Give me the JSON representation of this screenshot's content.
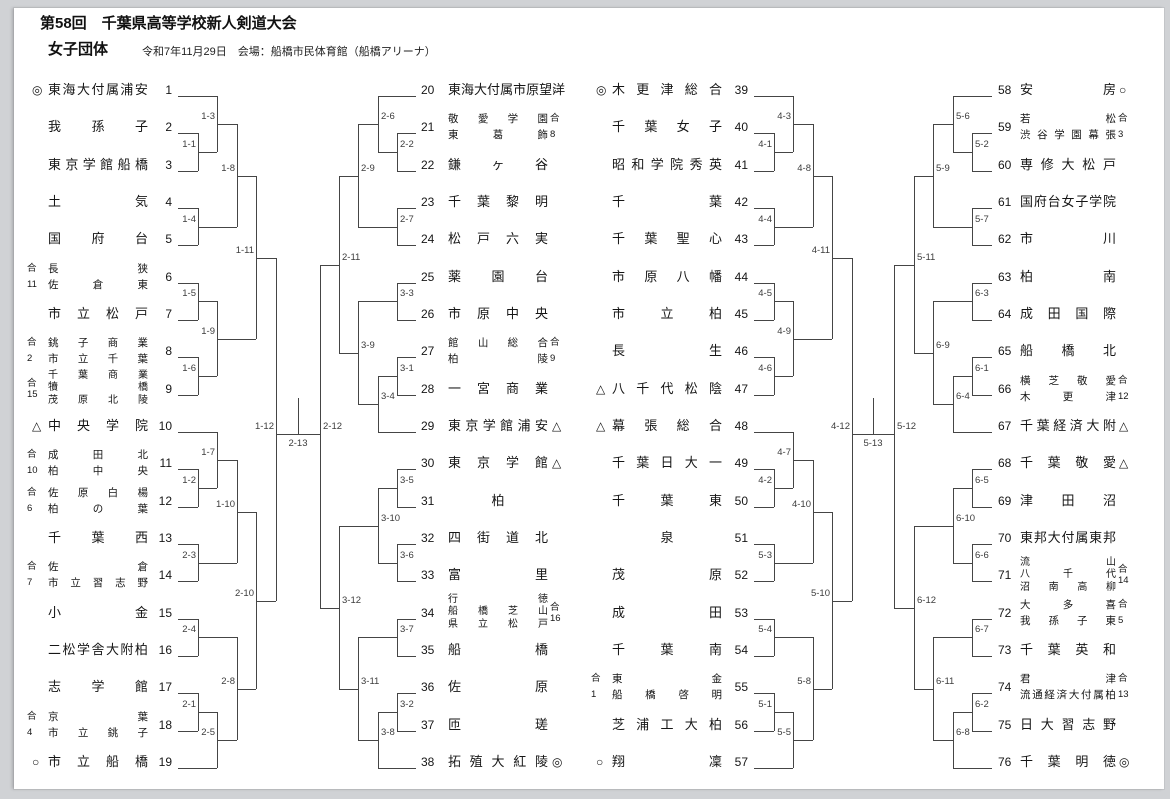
{
  "page": {
    "title": "第58回　千葉県高等学校新人剣道大会",
    "division": "女子団体",
    "date_venue": "令和7年11月29日　会場：船橋市民体育館（船橋アリーナ）",
    "joint_mark": "合"
  },
  "colors": {
    "line": "#454545",
    "text": "#161616",
    "label": "#3c3c3c",
    "page_bg": "#ffffff",
    "frame_bg": "#d0d2d5"
  },
  "finals": [
    "2-13",
    "5-13"
  ],
  "columns": [
    {
      "teams": [
        {
          "no": 1,
          "mark": "◎",
          "name": "東海大付属浦安"
        },
        {
          "no": 2,
          "name": "我孫子"
        },
        {
          "no": 3,
          "name": "東京学館船橋"
        },
        {
          "no": 4,
          "name": "土気"
        },
        {
          "no": 5,
          "name": "国府台"
        },
        {
          "no": 6,
          "joint": "11",
          "lines": [
            "長狭",
            "佐倉東"
          ]
        },
        {
          "no": 7,
          "name": "市立松戸"
        },
        {
          "no": 8,
          "joint": "2",
          "lines": [
            "銚子商業",
            "市立千葉"
          ]
        },
        {
          "no": 9,
          "joint": "15",
          "lines": [
            "千葉商業",
            "犢橋",
            "茂原北陵"
          ]
        },
        {
          "no": 10,
          "mark": "△",
          "name": "中央学院"
        },
        {
          "no": 11,
          "joint": "10",
          "lines": [
            "成田北",
            "柏中央"
          ]
        },
        {
          "no": 12,
          "joint": "6",
          "lines": [
            "佐原白楊",
            "柏の葉"
          ]
        },
        {
          "no": 13,
          "name": "千葉西"
        },
        {
          "no": 14,
          "joint": "7",
          "lines": [
            "佐倉",
            "市立習志野"
          ]
        },
        {
          "no": 15,
          "name": "小金"
        },
        {
          "no": 16,
          "name": "二松学舎大附柏"
        },
        {
          "no": 17,
          "name": "志学館"
        },
        {
          "no": 18,
          "joint": "4",
          "lines": [
            "京葉",
            "市立銚子"
          ]
        },
        {
          "no": 19,
          "mark": "○",
          "name": "市立船橋"
        }
      ],
      "bracket": [
        "1-12",
        [
          "1-11",
          [
            "1-8",
            [
              "1-3",
              0,
              [
                "1-1",
                1,
                2
              ]
            ],
            [
              "1-4",
              3,
              4
            ]
          ],
          [
            "1-9",
            [
              "1-5",
              5,
              6
            ],
            [
              "1-6",
              7,
              8
            ]
          ]
        ],
        [
          "2-10",
          [
            "1-10",
            [
              "1-7",
              9,
              [
                "1-2",
                10,
                11
              ]
            ],
            [
              "2-3",
              12,
              13
            ]
          ],
          [
            "2-8",
            [
              "2-4",
              14,
              15
            ],
            [
              "2-5",
              [
                "2-1",
                16,
                17
              ],
              18
            ]
          ]
        ]
      ]
    },
    {
      "teams": [
        {
          "no": 20,
          "name": "東海大付属市原望洋",
          "mark": "○"
        },
        {
          "no": 21,
          "joint": "8",
          "lines": [
            "敬愛学園",
            "東葛飾"
          ]
        },
        {
          "no": 22,
          "name": "鎌ヶ谷"
        },
        {
          "no": 23,
          "name": "千葉黎明"
        },
        {
          "no": 24,
          "name": "松戸六実"
        },
        {
          "no": 25,
          "name": "薬園台"
        },
        {
          "no": 26,
          "name": "市原中央"
        },
        {
          "no": 27,
          "joint": "9",
          "lines": [
            "館山総合",
            "柏陵"
          ]
        },
        {
          "no": 28,
          "name": "一宮商業"
        },
        {
          "no": 29,
          "name": "東京学館浦安",
          "mark": "△"
        },
        {
          "no": 30,
          "name": "東京学館",
          "mark": "△"
        },
        {
          "no": 31,
          "name": "柏"
        },
        {
          "no": 32,
          "name": "四街道北"
        },
        {
          "no": 33,
          "name": "富里"
        },
        {
          "no": 34,
          "joint": "16",
          "lines": [
            "行徳",
            "船橋芝山",
            "県立松戸"
          ]
        },
        {
          "no": 35,
          "name": "船橋"
        },
        {
          "no": 36,
          "name": "佐原"
        },
        {
          "no": 37,
          "name": "匝瑳"
        },
        {
          "no": 38,
          "name": "拓殖大紅陵",
          "mark": "◎"
        }
      ],
      "bracket": [
        "2-12",
        [
          "2-11",
          [
            "2-9",
            [
              "2-6",
              0,
              [
                "2-2",
                1,
                2
              ]
            ],
            [
              "2-7",
              3,
              4
            ]
          ],
          [
            "3-9",
            [
              "3-3",
              5,
              6
            ],
            [
              "3-4",
              [
                "3-1",
                7,
                8
              ],
              9
            ]
          ]
        ],
        [
          "3-12",
          [
            "3-10",
            [
              "3-5",
              10,
              11
            ],
            [
              "3-6",
              12,
              13
            ]
          ],
          [
            "3-11",
            [
              "3-7",
              14,
              15
            ],
            [
              "3-8",
              [
                "3-2",
                16,
                17
              ],
              18
            ]
          ]
        ]
      ]
    },
    {
      "teams": [
        {
          "no": 39,
          "mark": "◎",
          "name": "木更津総合"
        },
        {
          "no": 40,
          "name": "千葉女子"
        },
        {
          "no": 41,
          "name": "昭和学院秀英"
        },
        {
          "no": 42,
          "name": "千葉"
        },
        {
          "no": 43,
          "name": "千葉聖心"
        },
        {
          "no": 44,
          "name": "市原八幡"
        },
        {
          "no": 45,
          "name": "市立柏"
        },
        {
          "no": 46,
          "name": "長生"
        },
        {
          "no": 47,
          "mark": "△",
          "name": "八千代松陰"
        },
        {
          "no": 48,
          "mark": "△",
          "name": "幕張総合"
        },
        {
          "no": 49,
          "name": "千葉日大一"
        },
        {
          "no": 50,
          "name": "千葉東"
        },
        {
          "no": 51,
          "name": "泉"
        },
        {
          "no": 52,
          "name": "茂原"
        },
        {
          "no": 53,
          "name": "成田"
        },
        {
          "no": 54,
          "name": "千葉南"
        },
        {
          "no": 55,
          "joint": "1",
          "lines": [
            "東金",
            "船橋啓明"
          ]
        },
        {
          "no": 56,
          "name": "芝浦工大柏"
        },
        {
          "no": 57,
          "mark": "○",
          "name": "翔凜"
        }
      ],
      "bracket": [
        "4-12",
        [
          "4-11",
          [
            "4-8",
            [
              "4-3",
              0,
              [
                "4-1",
                1,
                2
              ]
            ],
            [
              "4-4",
              3,
              4
            ]
          ],
          [
            "4-9",
            [
              "4-5",
              5,
              6
            ],
            [
              "4-6",
              7,
              8
            ]
          ]
        ],
        [
          "5-10",
          [
            "4-10",
            [
              "4-7",
              9,
              [
                "4-2",
                10,
                11
              ]
            ],
            [
              "5-3",
              12,
              13
            ]
          ],
          [
            "5-8",
            [
              "5-4",
              14,
              15
            ],
            [
              "5-5",
              [
                "5-1",
                16,
                17
              ],
              18
            ]
          ]
        ]
      ]
    },
    {
      "teams": [
        {
          "no": 58,
          "name": "安房",
          "mark": "○"
        },
        {
          "no": 59,
          "joint": "3",
          "lines": [
            "若松",
            "渋谷学園幕張"
          ]
        },
        {
          "no": 60,
          "name": "専修大松戸"
        },
        {
          "no": 61,
          "name": "国府台女子学院"
        },
        {
          "no": 62,
          "name": "市川"
        },
        {
          "no": 63,
          "name": "柏南"
        },
        {
          "no": 64,
          "name": "成田国際"
        },
        {
          "no": 65,
          "name": "船橋北"
        },
        {
          "no": 66,
          "joint": "12",
          "lines": [
            "横芝敬愛",
            "木更津"
          ]
        },
        {
          "no": 67,
          "name": "千葉経済大附",
          "mark": "△"
        },
        {
          "no": 68,
          "name": "千葉敬愛",
          "mark": "△"
        },
        {
          "no": 69,
          "name": "津田沼"
        },
        {
          "no": 70,
          "name": "東邦大付属東邦"
        },
        {
          "no": 71,
          "joint": "14",
          "lines": [
            "流山",
            "八千代",
            "沼南高柳"
          ]
        },
        {
          "no": 72,
          "joint": "5",
          "lines": [
            "大多喜",
            "我孫子東"
          ]
        },
        {
          "no": 73,
          "name": "千葉英和"
        },
        {
          "no": 74,
          "joint": "13",
          "lines": [
            "君津",
            "流通経済大付属柏"
          ]
        },
        {
          "no": 75,
          "name": "日大習志野"
        },
        {
          "no": 76,
          "name": "千葉明徳",
          "mark": "◎"
        }
      ],
      "bracket": [
        "5-12",
        [
          "5-11",
          [
            "5-9",
            [
              "5-6",
              0,
              [
                "5-2",
                1,
                2
              ]
            ],
            [
              "5-7",
              3,
              4
            ]
          ],
          [
            "6-9",
            [
              "6-3",
              5,
              6
            ],
            [
              "6-4",
              [
                "6-1",
                7,
                8
              ],
              9
            ]
          ]
        ],
        [
          "6-12",
          [
            "6-10",
            [
              "6-5",
              10,
              11
            ],
            [
              "6-6",
              12,
              13
            ]
          ],
          [
            "6-11",
            [
              "6-7",
              14,
              15
            ],
            [
              "6-8",
              [
                "6-2",
                16,
                17
              ],
              18
            ]
          ]
        ]
      ]
    }
  ]
}
